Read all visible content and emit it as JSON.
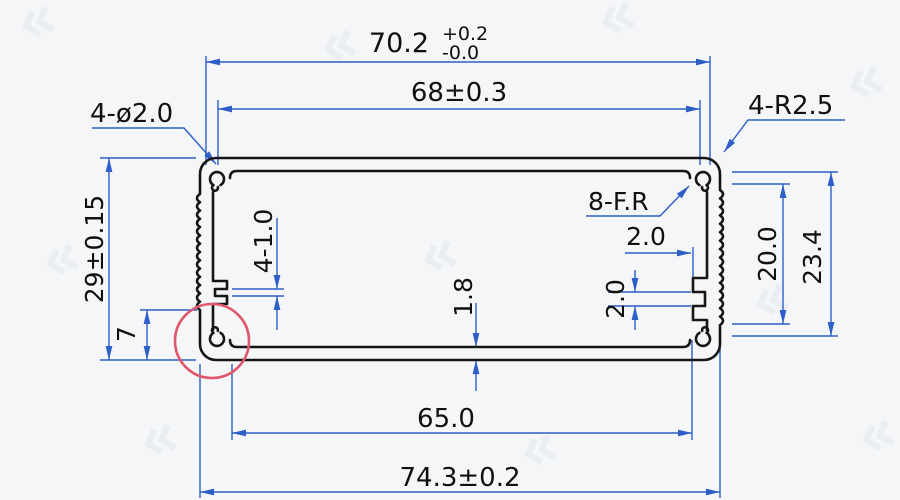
{
  "drawing": {
    "type": "aluminum-extrusion-enclosure-cross-section",
    "labels": {
      "width_top": "70.2",
      "width_top_tol_plus": "+0.2",
      "width_top_tol_minus": "-0.0",
      "width_inner_top": "68±0.3",
      "corner_holes": "4-ø2.0",
      "corner_radius": "4-R2.5",
      "fillet_radius": "8-F.R",
      "height_overall": "29±0.15",
      "groove_offset": "7",
      "slot_left": "4-1.0",
      "wall_thickness": "1.8",
      "rib_depth": "2.0",
      "rib_pitch": "2.0",
      "height_inner_right": "20.0",
      "height_outer_right": "23.4",
      "width_inner_bottom": "65.0",
      "width_bottom": "74.3±0.2"
    },
    "colors": {
      "outline": "#161616",
      "dimension": "#2e5fc8",
      "highlight_circle": "#e0566b",
      "background": "#f4f6f8",
      "watermark": "#e2e8f1"
    }
  }
}
